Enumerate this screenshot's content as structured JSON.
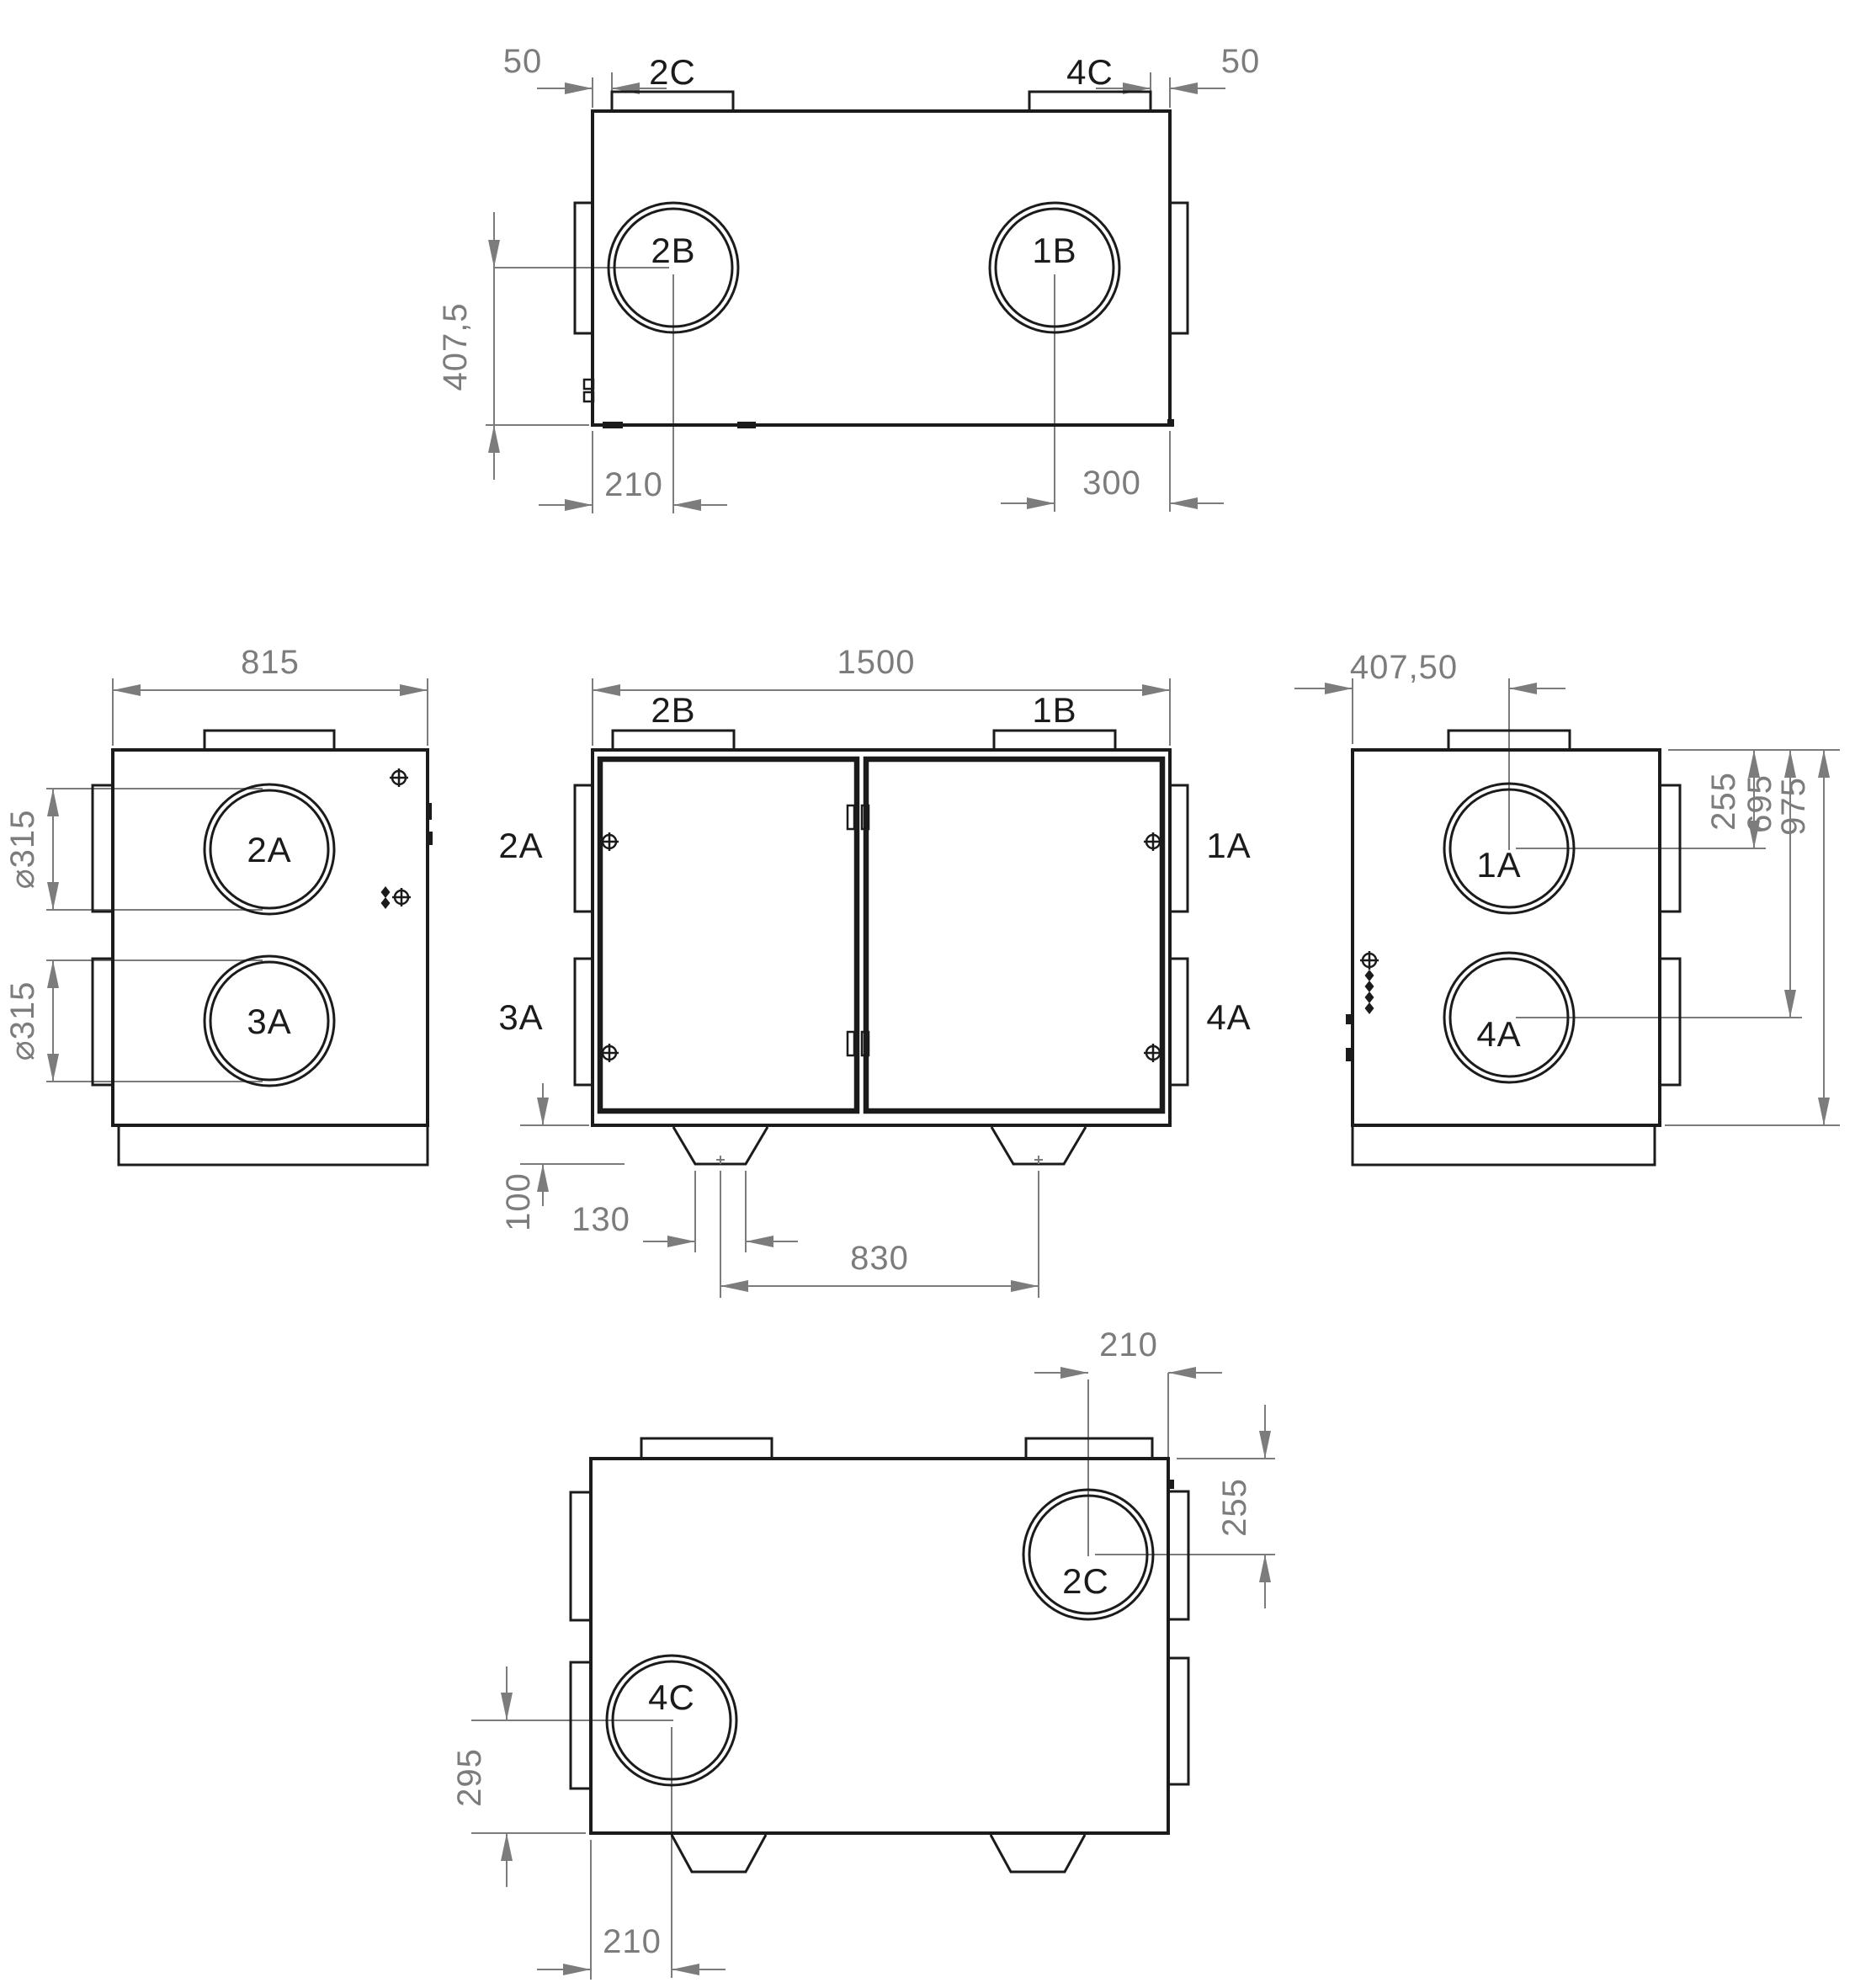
{
  "drawing_title": "heat-recovery-ventilation-unit-dimension-drawing",
  "colors": {
    "object_line": "#1b1b1b",
    "dimension_line": "#7c7c7c",
    "background": "#ffffff"
  },
  "views": {
    "top": {
      "dim_left_offset": "50",
      "dim_right_offset": "50",
      "tab_left": "2C",
      "tab_right": "4C",
      "port_left": "2B",
      "port_right": "1B",
      "dim_port_height": "407,5",
      "dim_port_left_x": "210",
      "dim_port_right_x": "300"
    },
    "left": {
      "dim_depth": "815",
      "port_top": "2A",
      "port_bottom": "3A",
      "dim_dia_top": "⌀315",
      "dim_dia_bottom": "⌀315"
    },
    "front": {
      "dim_width": "1500",
      "duct_top_left": "2B",
      "duct_top_right": "1B",
      "side_top_left": "2A",
      "side_bottom_left": "3A",
      "side_top_right": "1A",
      "side_bottom_right": "4A",
      "dim_foot_height": "100",
      "dim_foot_width": "130",
      "dim_feet_spacing": "830"
    },
    "right": {
      "dim_port_x": "407,50",
      "port_top": "1A",
      "port_bottom": "4A",
      "dim_port_top_y": "255",
      "dim_port_bottom_y": "695",
      "dim_height": "975"
    },
    "bottom": {
      "dim_port_right_x": "210",
      "dim_port_right_y": "255",
      "port_right": "2C",
      "port_left": "4C",
      "dim_port_left_y": "295",
      "dim_port_left_x": "210"
    }
  }
}
